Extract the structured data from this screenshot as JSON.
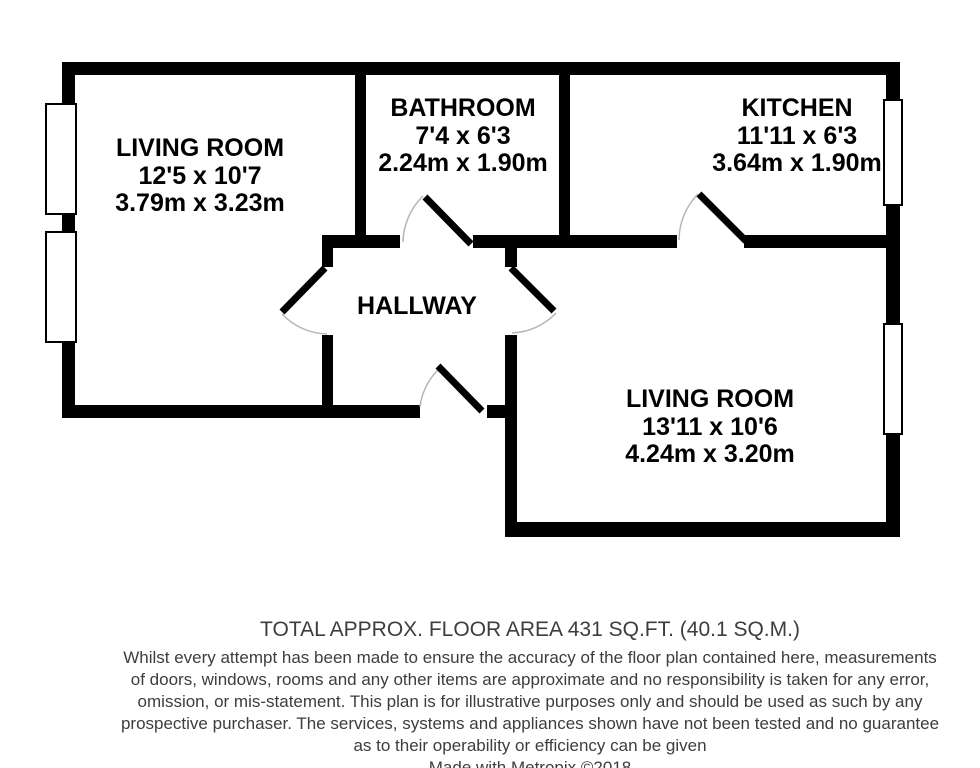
{
  "floor_plan": {
    "rooms": [
      {
        "id": "living-room-1",
        "name": "LIVING ROOM",
        "imperial": "12'5 x 10'7",
        "metric": "3.79m x 3.23m"
      },
      {
        "id": "bathroom",
        "name": "BATHROOM",
        "imperial": "7'4 x 6'3",
        "metric": "2.24m x 1.90m"
      },
      {
        "id": "kitchen",
        "name": "KITCHEN",
        "imperial": "11'11 x 6'3",
        "metric": "3.64m x 1.90m"
      },
      {
        "id": "hallway",
        "name": "HALLWAY"
      },
      {
        "id": "living-room-2",
        "name": "LIVING ROOM",
        "imperial": "13'11 x 10'6",
        "metric": "4.24m x 3.20m"
      }
    ]
  },
  "footer": {
    "total_area": "TOTAL APPROX. FLOOR AREA 431 SQ.FT. (40.1 SQ.M.)",
    "disclaimer_lines": [
      "Whilst every attempt has been made to ensure the accuracy of the floor plan contained here, measurements",
      "of doors, windows, rooms and any other items are approximate and no responsibility is taken for any error,",
      "omission, or mis-statement. This plan is for illustrative purposes only and should be used as such by any",
      "prospective purchaser. The services, systems and appliances shown have not been tested and no guarantee",
      "as to their operability or efficiency can be given"
    ],
    "credit": "Made with Metropix ©2018"
  },
  "colors": {
    "wall": "#000000",
    "window_fill": "#ffffff",
    "door_arc": "#b5b5b5",
    "label_text": "#000000",
    "footer_text": "#3d3d3d"
  }
}
